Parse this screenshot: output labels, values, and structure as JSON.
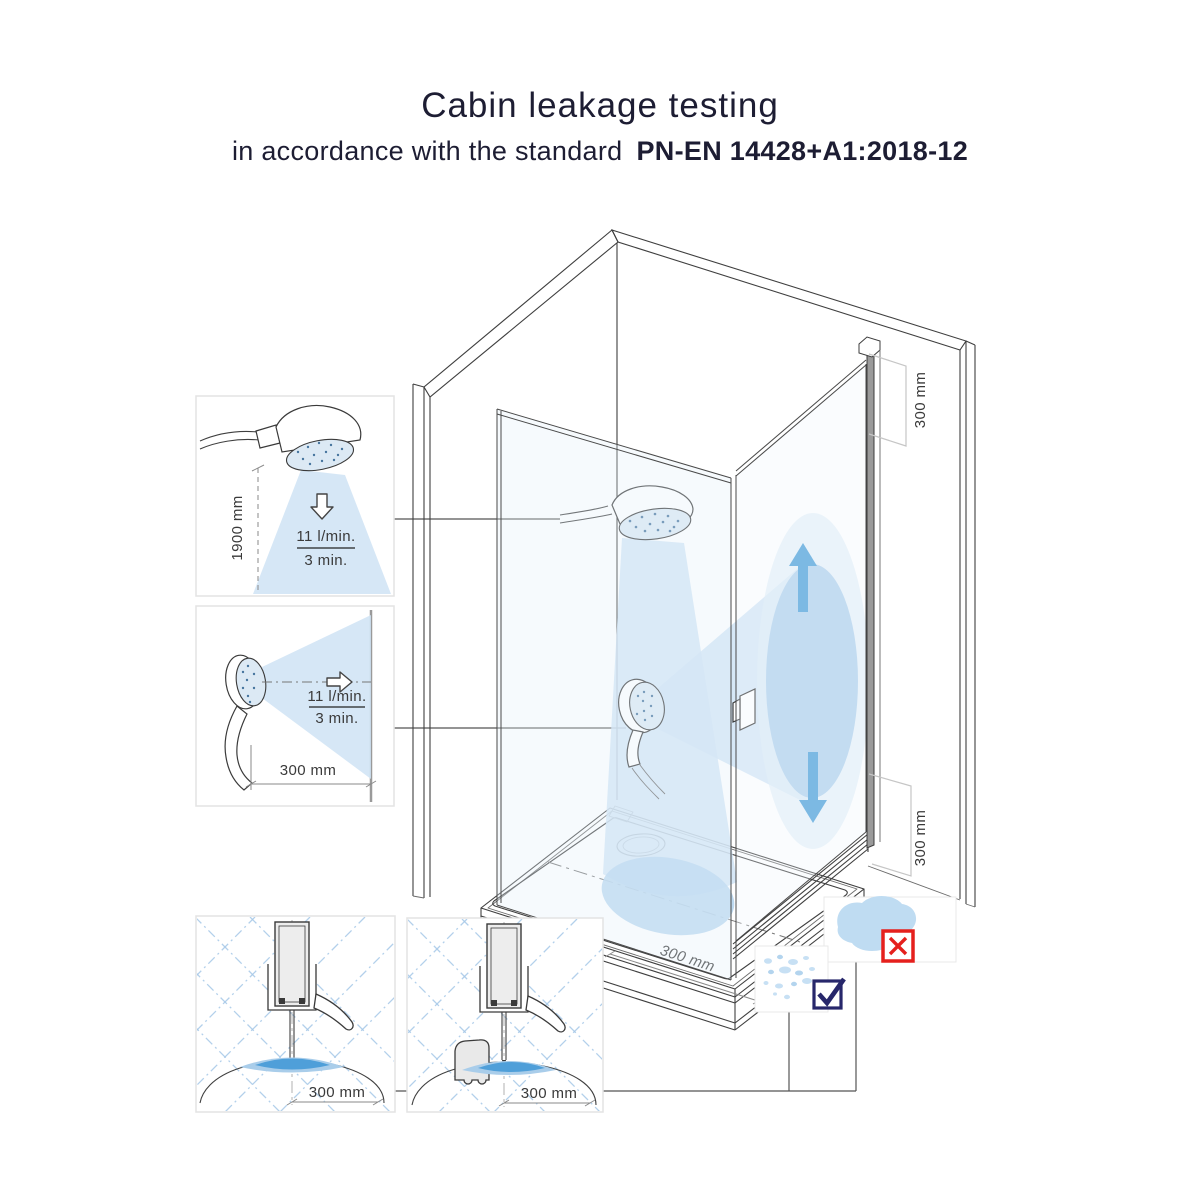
{
  "header": {
    "title": "Cabin leakage testing",
    "subtitle_prefix": "in accordance with the standard",
    "standard_code": "PN-EN 14428+A1:2018-12"
  },
  "insets": {
    "vertical_spray": {
      "height_dimension": "1900 mm",
      "flow_rate": "11 l/min.",
      "duration": "3 min."
    },
    "horizontal_spray": {
      "distance_dimension": "300 mm",
      "flow_rate": "11 l/min.",
      "duration": "3 min."
    },
    "seal_plain": {
      "distance_dimension": "300 mm"
    },
    "seal_threshold": {
      "distance_dimension": "300 mm"
    }
  },
  "cabin": {
    "door_top_dimension": "300 mm",
    "door_bottom_dimension": "300 mm",
    "tray_dimension": "300 mm"
  },
  "icons": {
    "fail": "red-x-icon",
    "pass": "navy-check-icon"
  },
  "colors": {
    "ink": "#1d1d33",
    "line": "#3f3f3f",
    "spray_light": "#cfe3f4",
    "splash_mid": "#aed0ec",
    "water_blue": "#4b9fd8",
    "fail_red": "#e5201d",
    "pass_navy": "#27276b"
  }
}
